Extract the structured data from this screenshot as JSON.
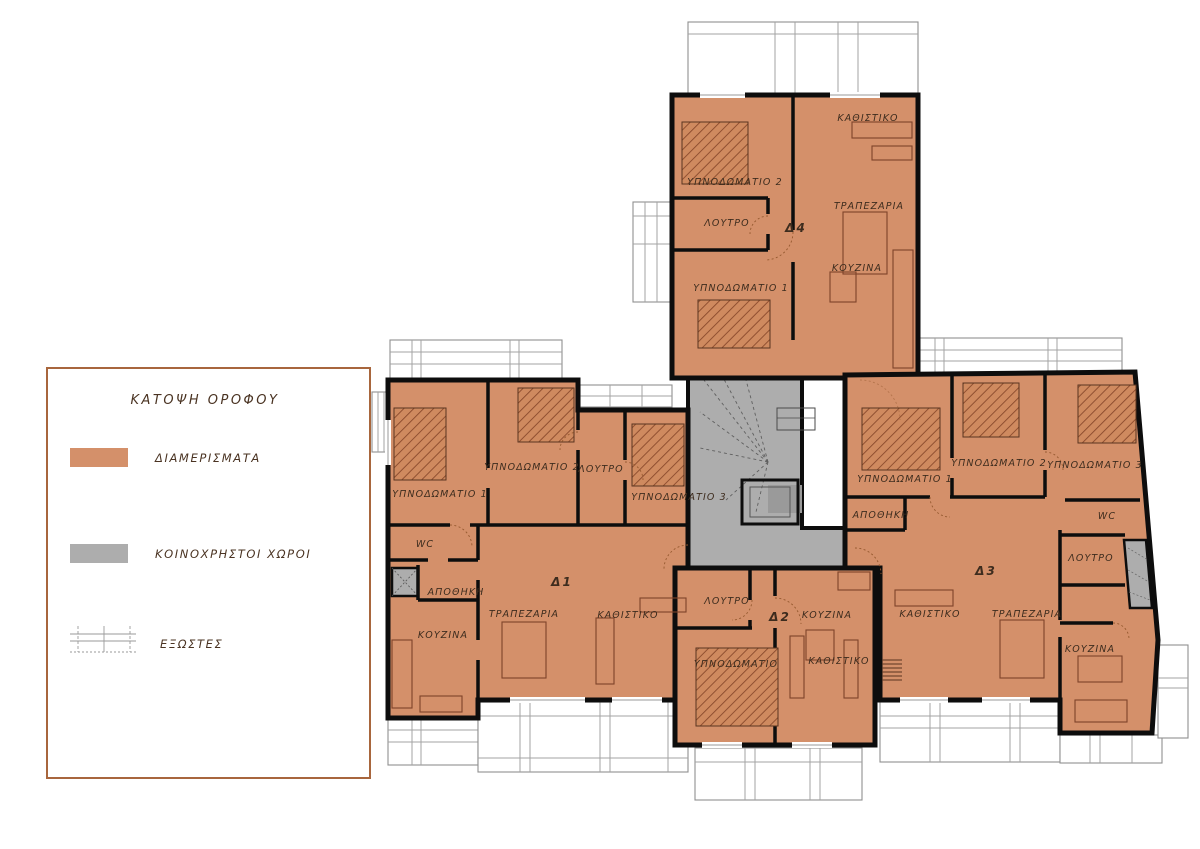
{
  "title": "ΚΑΤΟΨΗ ΟΡΟΦΟΥ",
  "legend": {
    "title": "ΚΑΤΟΨΗ ΟΡΟΦΟΥ",
    "items": [
      {
        "key": "apartments",
        "label": "ΔΙΑΜΕΡΙΣΜΑΤΑ",
        "swatch": "#d4906a"
      },
      {
        "key": "common-areas",
        "label": "ΚΟΙΝΟΧΡΗΣΤΟΙ ΧΩΡΟΙ",
        "swatch": "#adadad"
      },
      {
        "key": "balconies",
        "label": "ΕΞΩΣΤΕΣ",
        "swatch": "balcony-grid"
      }
    ]
  },
  "colors": {
    "apartment": "#d4906a",
    "common": "#adadad",
    "wall": "#0d0d0d",
    "legend_border": "#a8663d",
    "label": "#3d2c1e"
  },
  "apartments": {
    "d1": {
      "id": "Δ1",
      "rooms": {
        "bedroom1": "ΥΠΝΟΔΩΜΑΤΙΟ 1",
        "bedroom2": "ΥΠΝΟΔΩΜΑΤΙΟ 2",
        "bedroom3": "ΥΠΝΟΔΩΜΑΤΙΟ 3",
        "bath": "ΛΟΥΤΡΟ",
        "wc": "WC",
        "storage": "ΑΠΟΘΗΚΗ",
        "dining": "ΤΡΑΠΕΖΑΡΙΑ",
        "living": "ΚΑΘΙΣΤΙΚΟ",
        "kitchen": "ΚΟΥΖΙΝΑ"
      }
    },
    "d2": {
      "id": "Δ2",
      "rooms": {
        "bath": "ΛΟΥΤΡΟ",
        "kitchen": "ΚΟΥΖΙΝΑ",
        "bedroom": "ΥΠΝΟΔΩΜΑΤΙΟ",
        "living": "ΚΑΘΙΣΤΙΚΟ"
      }
    },
    "d3": {
      "id": "Δ3",
      "rooms": {
        "bedroom1": "ΥΠΝΟΔΩΜΑΤΙΟ 1",
        "bedroom2": "ΥΠΝΟΔΩΜΑΤΙΟ 2",
        "bedroom3": "ΥΠΝΟΔΩΜΑΤΙΟ 3",
        "storage": "ΑΠΟΘΗΚΗ",
        "wc": "WC",
        "bath": "ΛΟΥΤΡΟ",
        "living": "ΚΑΘΙΣΤΙΚΟ",
        "dining": "ΤΡΑΠΕΖΑΡΙΑ",
        "kitchen": "ΚΟΥΖΙΝΑ"
      }
    },
    "d4": {
      "id": "Δ4",
      "rooms": {
        "living": "ΚΑΘΙΣΤΙΚΟ",
        "bedroom2": "ΥΠΝΟΔΩΜΑΤΙΟ 2",
        "bath": "ΛΟΥΤΡΟ",
        "dining": "ΤΡΑΠΕΖΑΡΙΑ",
        "kitchen": "ΚΟΥΖΙΝΑ",
        "bedroom1": "ΥΠΝΟΔΩΜΑΤΙΟ 1"
      }
    }
  }
}
